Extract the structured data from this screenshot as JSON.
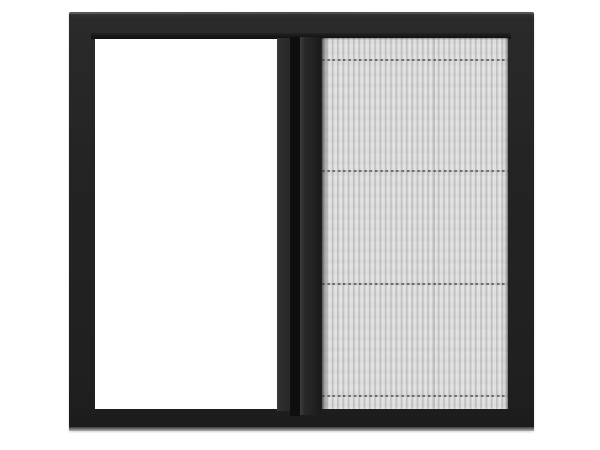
{
  "scene": {
    "type": "product-photo",
    "subject": "Sliding window with pleated insect mesh screen",
    "background_color": "#ffffff",
    "parts": {
      "frame": {
        "label": "Dark aluminium window frame",
        "color": "#232323",
        "top_edge_highlight": "#4d4d4d",
        "sill_highlight": "#9a9a9a"
      },
      "glass_pane": {
        "label": "Open white pane, left half",
        "color": "#ffffff"
      },
      "sash_stile": {
        "label": "Vertical sash stile between pane and screen",
        "color": "#2e2e2e"
      },
      "track_gap": {
        "label": "Dark sliding track groove",
        "color": "#0e0e0e"
      },
      "screen_rail": {
        "label": "Pleated-screen pull rail",
        "color": "#222222"
      },
      "mesh": {
        "label": "Pleated mesh screen, right half",
        "pleat_light_color": "#e7e7e7",
        "pleat_dark_color": "#bcbcbc",
        "pleat_spacing_px": 5.3,
        "divider_color": "#2d2d2d",
        "divider_count": 4,
        "divider_style": "dashed horizontal support cords"
      }
    }
  }
}
